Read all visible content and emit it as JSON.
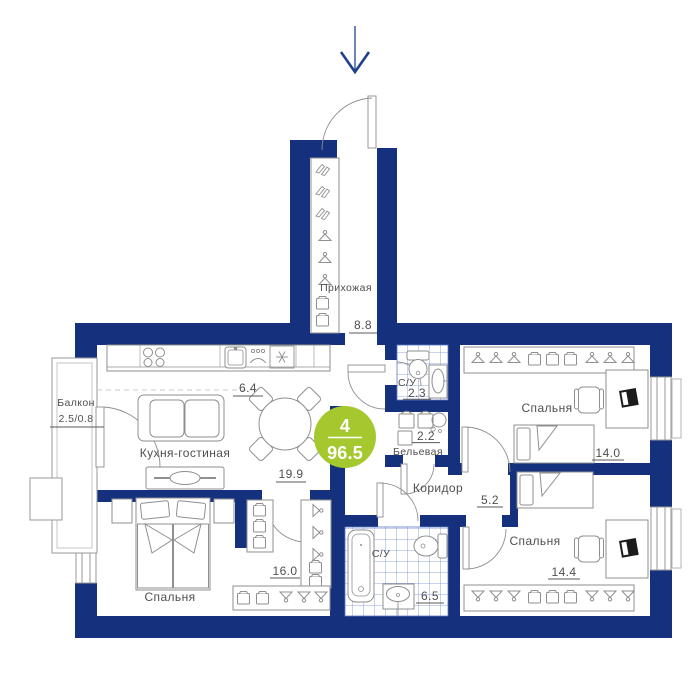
{
  "app": {
    "type": "apartment-floor-plan"
  },
  "badge": {
    "rooms_count": "4",
    "total_area": "96.5"
  },
  "rooms": {
    "hallway": {
      "label": "Прихожая",
      "area": "8.8"
    },
    "kitchen_living": {
      "label": "Кухня-гостиная",
      "area_dining": "6.4",
      "area_living": "19.9"
    },
    "bathroom_top": {
      "label": "С/У",
      "area": "2.3"
    },
    "linen": {
      "label": "Бельевая",
      "area": "2.2"
    },
    "corridor": {
      "label": "Коридор",
      "area": "5.2"
    },
    "bedroom_right_top": {
      "label": "Спальня",
      "area": "14.0"
    },
    "bedroom_right_bottom": {
      "label": "Спальня",
      "area": "14.4"
    },
    "bedroom_left": {
      "label": "Спальня",
      "area": "16.0"
    },
    "bathroom_bottom": {
      "label": "С/У",
      "area": "6.5"
    },
    "balcony": {
      "label": "Балкон",
      "area": "2.5/0.8"
    }
  },
  "colors": {
    "wall": "#15317e",
    "tile_line": "#5b79c8",
    "badge": "#a6c82f",
    "furniture": "#8f8f8f",
    "text": "#4f4f4f",
    "arrow": "#2f54a0"
  }
}
